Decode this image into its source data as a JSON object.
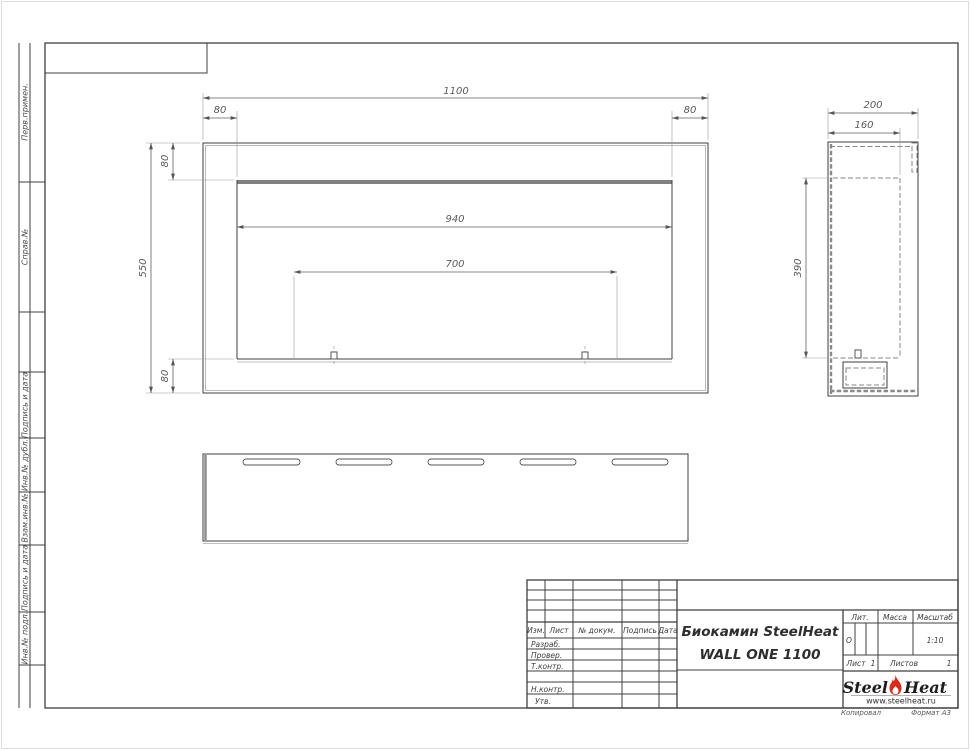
{
  "page": {
    "copied_label": "Копировал",
    "format_label": "Формат А3"
  },
  "left_stamp": {
    "cells": [
      "Перв.примен.",
      "Справ.№",
      "Подпись и дата",
      "Инв.№ дубл.",
      "Взам.инв.№",
      "Подпись и дата",
      "Инв.№ подл."
    ]
  },
  "title_block": {
    "header_cols": [
      "Изм.",
      "Лист",
      "№ докум.",
      "Подпись",
      "Дата"
    ],
    "rows": [
      "Разраб.",
      "Провер.",
      "Т.контр.",
      "Н.контр.",
      "Утв."
    ],
    "title_line1": "Биокамин SteelHeat",
    "title_line2": "WALL ONE 1100",
    "lit_label": "Лит.",
    "mass_label": "Масса",
    "scale_label": "Масштаб",
    "lit_value": "О",
    "scale_value": "1:10",
    "sheet_label": "Лист",
    "sheet_value": "1",
    "sheets_label": "Листов",
    "sheets_value": "1",
    "logo_steel": "Steel",
    "logo_heat": "Heat",
    "logo_url": "www.steelheat.ru",
    "flame_color": "#e02818"
  },
  "dims": {
    "front_width": "1100",
    "front_height": "550",
    "front_offset_left": "80",
    "front_offset_right": "80",
    "front_offset_top": "80",
    "front_offset_bottom": "80",
    "opening_width": "940",
    "burner_width": "700",
    "side_depth": "200",
    "side_inner_depth": "160",
    "side_height": "390"
  }
}
